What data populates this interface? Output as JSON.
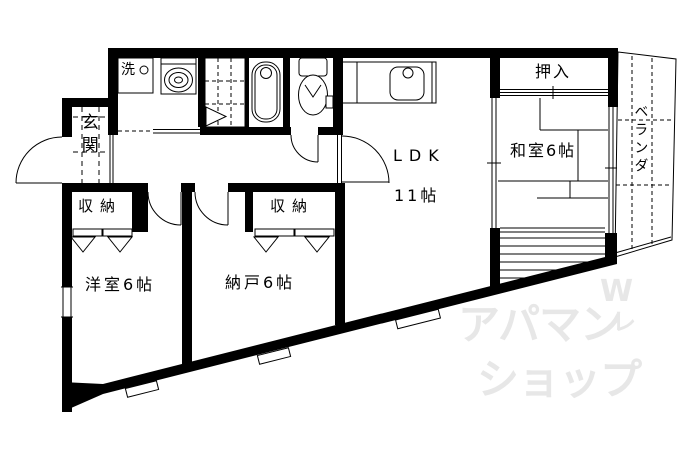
{
  "colors": {
    "wall": "#000000",
    "background": "#ffffff",
    "watermark": "#e7e7e7"
  },
  "plan": {
    "genkan_label": "玄関",
    "washing_machine_label": "洗",
    "ldk_label": "LDK",
    "ldk_size_label": "11帖",
    "washitsu_label": "和室6帖",
    "oshiire_label": "押入",
    "veranda_label": "ベランダ",
    "youshitsu_label": "洋室6帖",
    "nando_label": "納戸6帖",
    "closet_left_label": "収納",
    "closet_right_label": "収納"
  },
  "watermark": {
    "line1": "アパマン",
    "logo_w": "W",
    "logo_stroke": "レ",
    "line2": "ショップ"
  }
}
